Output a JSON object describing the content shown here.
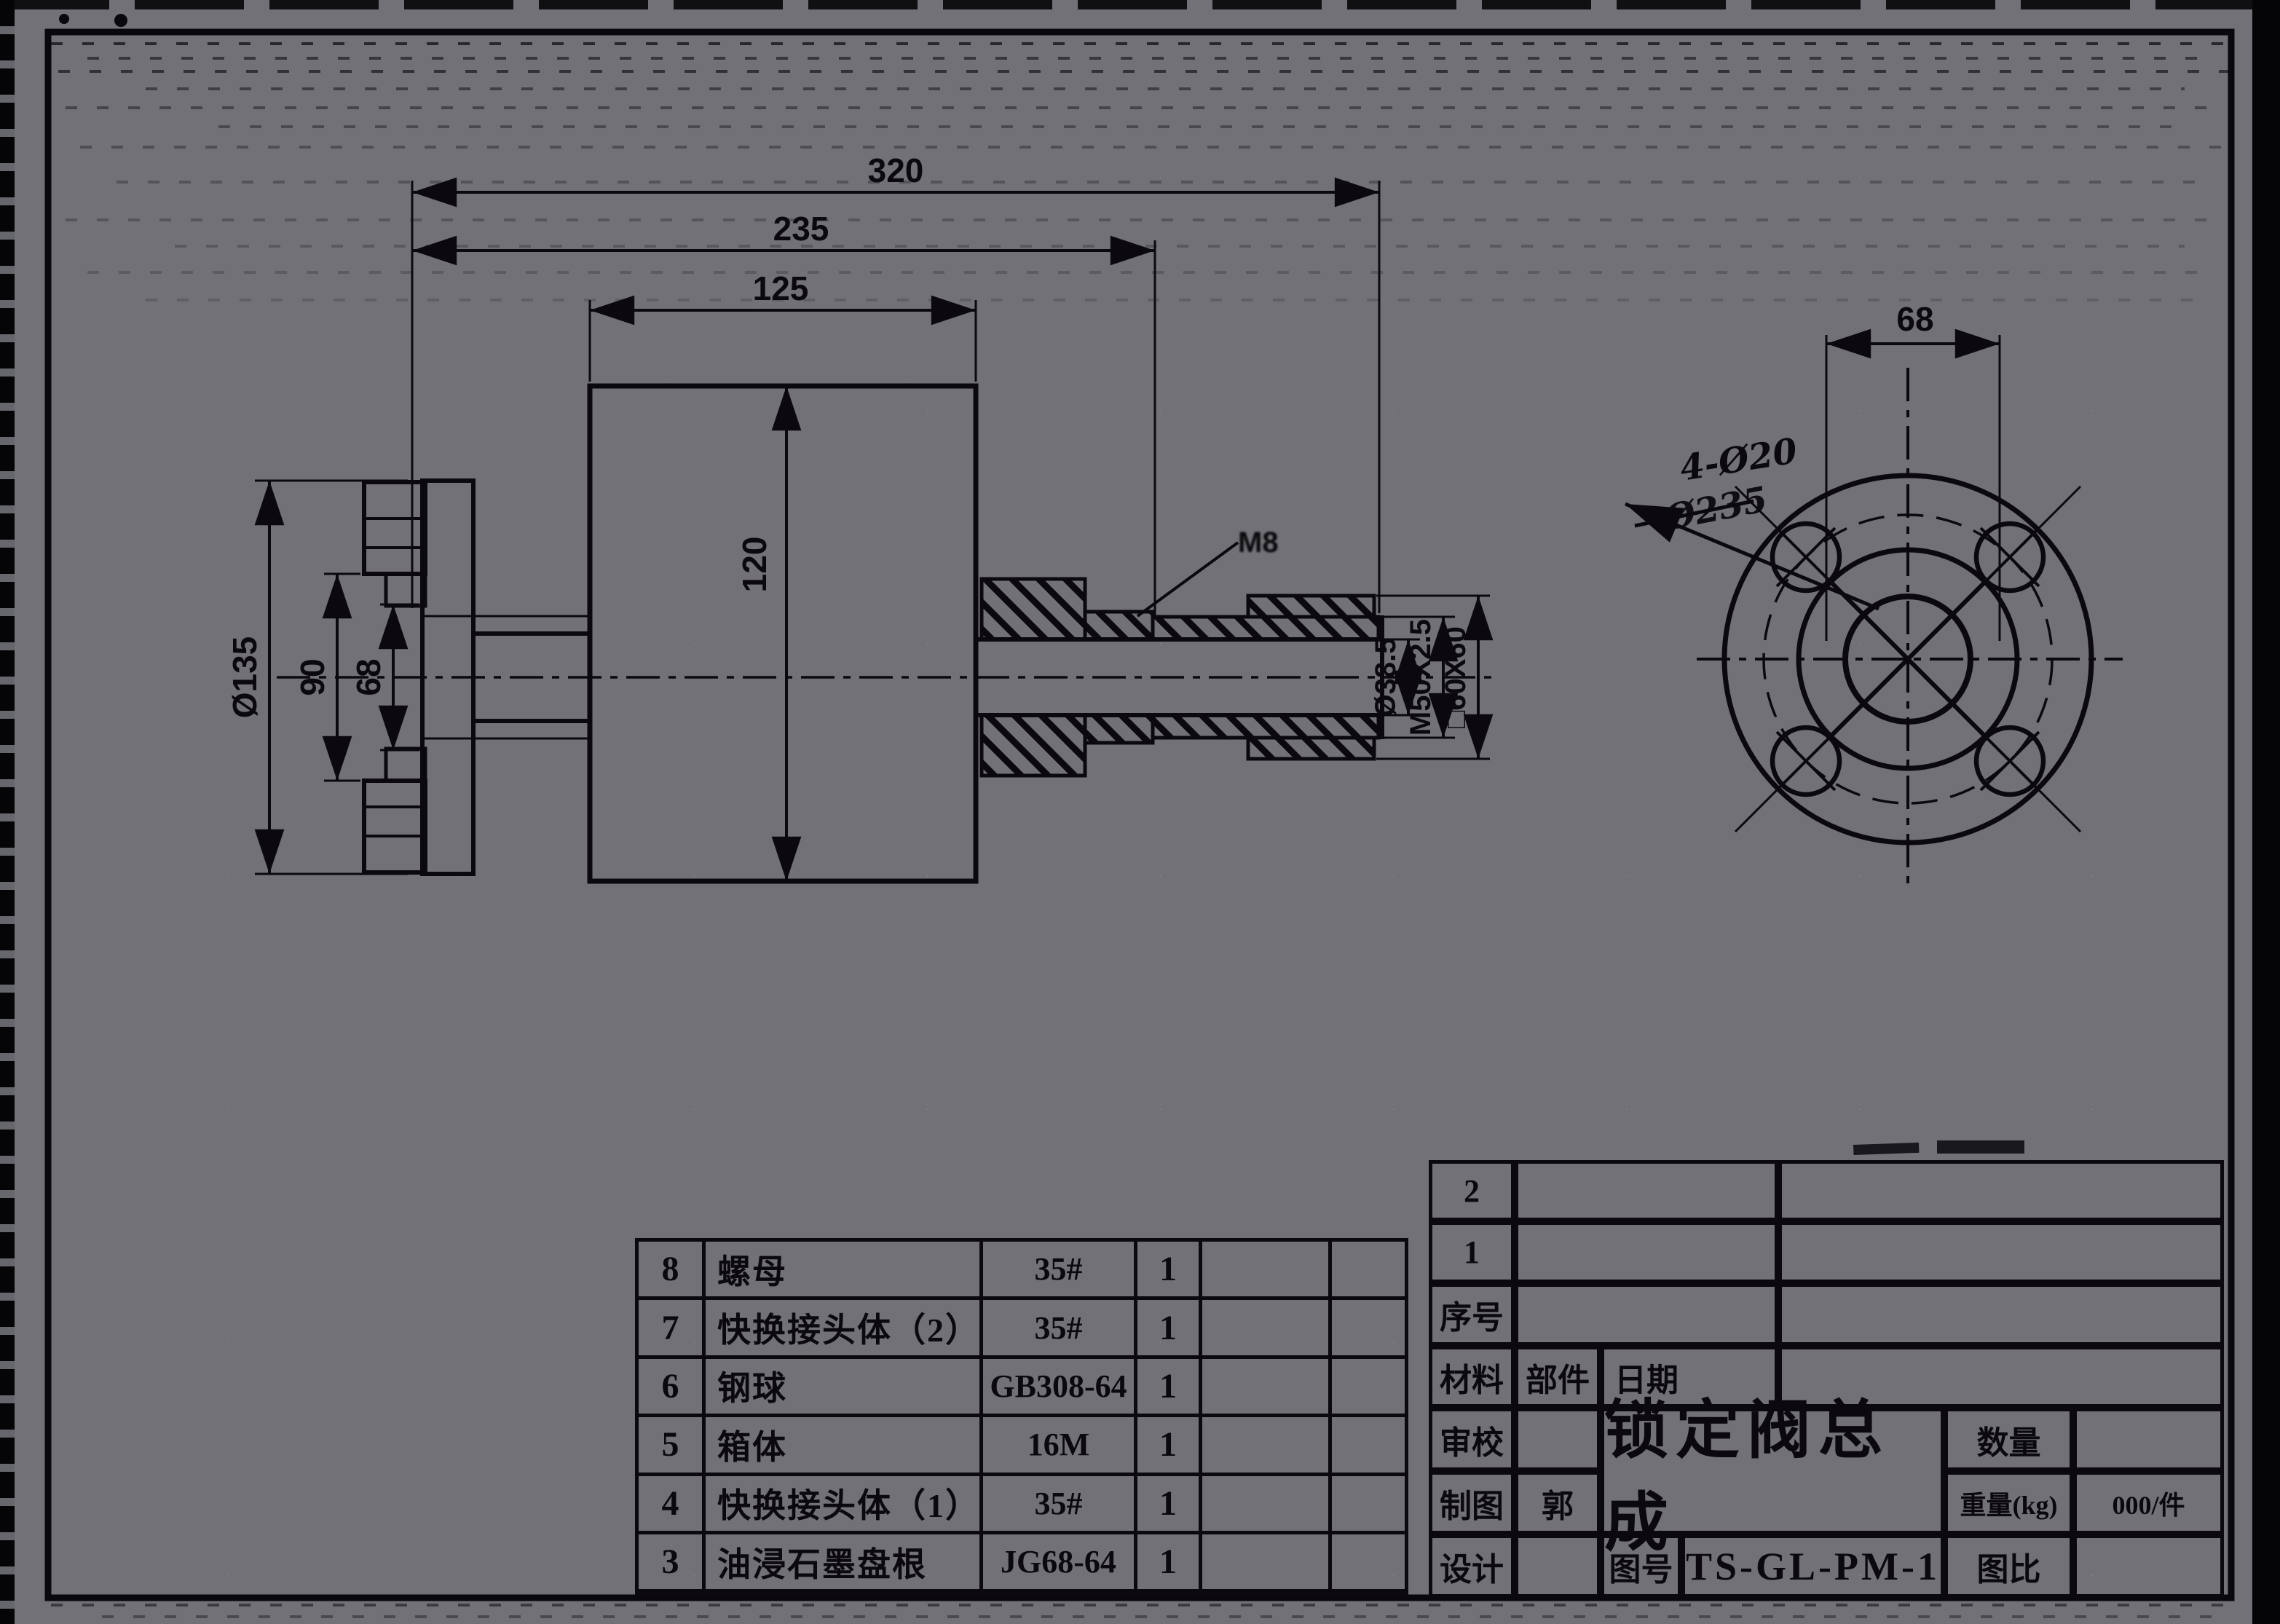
{
  "colors": {
    "paper": "#e7e5f0",
    "ink": "#17141c"
  },
  "dimensions": {
    "overall_length": "320",
    "to_gland_face": "235",
    "body_width": "125",
    "body_height": "120",
    "flange_od": "Ø135",
    "bolt_span": "90",
    "hub_span": "68",
    "bore": "Ø38.5",
    "thread": "M50X2.5",
    "square": "□60X60",
    "leader_note": "M8",
    "front_width": "68",
    "holes_callout": "4-Ø20",
    "struck_callout": "Ø235"
  },
  "bom": {
    "rows": [
      {
        "no": "8",
        "name": "螺母",
        "spec": "35#",
        "qty": "1"
      },
      {
        "no": "7",
        "name": "快换接头体（2）",
        "spec": "35#",
        "qty": "1"
      },
      {
        "no": "6",
        "name": "钢球",
        "spec": "GB308-64",
        "qty": "1"
      },
      {
        "no": "5",
        "name": "箱体",
        "spec": "16M",
        "qty": "1"
      },
      {
        "no": "4",
        "name": "快换接头体（1）",
        "spec": "35#",
        "qty": "1"
      },
      {
        "no": "3",
        "name": "油浸石墨盘根",
        "spec": "JG68-64",
        "qty": "1"
      }
    ]
  },
  "title_block": {
    "seq_2": "2",
    "seq_1": "1",
    "seq_label": "序号",
    "material": "材料",
    "part": "部件",
    "date": "日期",
    "check": "审校",
    "draft": "制图",
    "draft_by": "郭",
    "design": "设计",
    "title": "锁定阀总成",
    "qty_label": "数量",
    "weight_label": "重量(kg)",
    "weight_val": "000/件",
    "drawing_no_label": "图号",
    "drawing_no": "TS-GL-PM-1",
    "scale_label": "图比"
  }
}
